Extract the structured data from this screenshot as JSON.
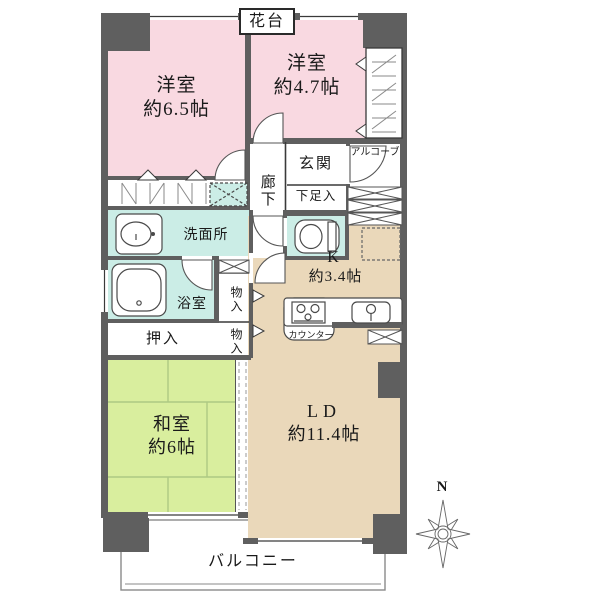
{
  "rooms": {
    "western_6_5": {
      "name": "洋室",
      "size": "約6.5帖"
    },
    "western_4_7": {
      "name": "洋室",
      "size": "約4.7帖"
    },
    "japanese_room": {
      "name": "和室",
      "size": "約6帖"
    },
    "living_dining": {
      "name": "LD",
      "size": "約11.4帖"
    },
    "kitchen": {
      "name": "K",
      "size": "約3.4帖"
    }
  },
  "labels": {
    "flower_stand": "花台",
    "alcove": "アルコーブ",
    "entrance": "玄関",
    "shoe_cabinet": "下足入",
    "corridor": "廊下",
    "washroom": "洗面所",
    "bathroom": "浴室",
    "storage_upper": "物入",
    "storage_lower": "物入",
    "futon_closet": "押入",
    "counter": "カウンター",
    "balcony": "バルコニー",
    "compass_north": "N"
  },
  "colors": {
    "wall": "#5f5f5f",
    "western_room": "#f9d9e1",
    "wet_area": "#cbede6",
    "living_kitchen": "#ead8ba",
    "japanese_room": "#d9ee9e"
  }
}
